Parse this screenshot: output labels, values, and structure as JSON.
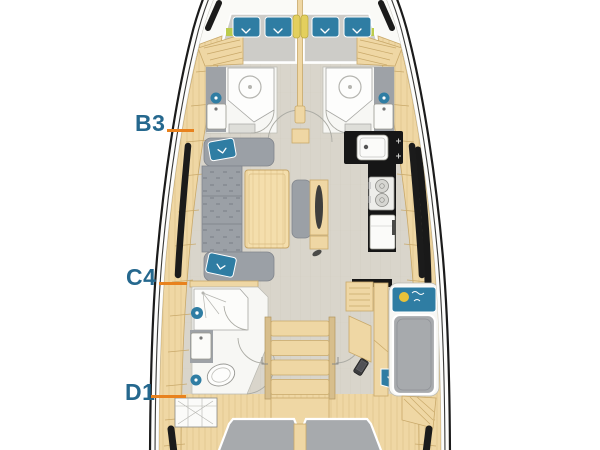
{
  "diagram": {
    "title": "sailing-yacht interior layout plan, top view",
    "labels": [
      {
        "text": "B3",
        "points_to": "forward-port-hull-section"
      },
      {
        "text": "C4",
        "points_to": "salon-port-hull-section"
      },
      {
        "text": "D1",
        "points_to": "aft-port-hull-section"
      }
    ],
    "colors": {
      "label": "#25688E",
      "leader": "#E8821E",
      "hull-line": "#1B1B1B",
      "wood": "#EFD7A4",
      "wood-edge": "#C9A96A",
      "floor": "#D9D5CB",
      "upholstery": "#9BA0A6",
      "mattress-dark": "#A7AAAD",
      "mattress-light": "#CDCCC8",
      "teal": "#2F7DA3",
      "counter": "#161616",
      "tile": "#9EA2A7",
      "fixture": "#FBFBF9",
      "accent-yellow": "#E3CF5E",
      "accent-lime": "#BBCB4D",
      "sun": "#E8C23A"
    }
  }
}
